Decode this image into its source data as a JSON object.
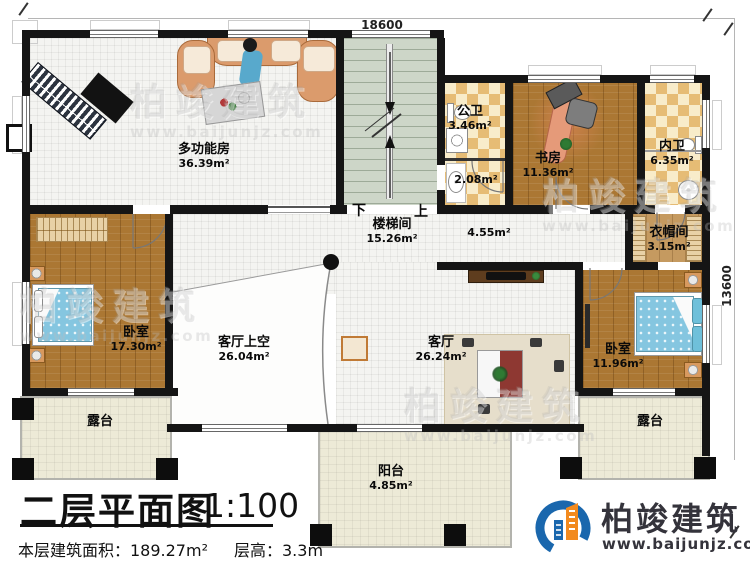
{
  "titleblock": {
    "title": "二层平面图",
    "scale": "1:100",
    "area_text": "本层建筑面积：189.27m²",
    "height_text": "层高：3.3m"
  },
  "dimensions": {
    "top": "18600",
    "right": "13600"
  },
  "stairs": {
    "down_label": "下",
    "up_label": "上"
  },
  "rooms": {
    "multi": {
      "name": "多功能房",
      "area": "36.39m²"
    },
    "public_bath": {
      "name": "公卫",
      "area": "3.46m²"
    },
    "bath_lobby": {
      "area": "2.08m²"
    },
    "study": {
      "name": "书房",
      "area": "11.36m²"
    },
    "inner_bath": {
      "name": "内卫",
      "area": "6.35m²"
    },
    "stairwell": {
      "name": "楼梯间",
      "area": "15.26m²"
    },
    "corridor": {
      "area": "4.55m²"
    },
    "cloakroom": {
      "name": "衣帽间",
      "area": "3.15m²"
    },
    "bedroom_left": {
      "name": "卧室",
      "area": "17.30m²"
    },
    "living_void": {
      "name": "客厅上空",
      "area": "26.04m²"
    },
    "living": {
      "name": "客厅",
      "area": "26.24m²"
    },
    "bedroom_right": {
      "name": "卧室",
      "area": "11.96m²"
    },
    "terrace_left": {
      "name": "露台"
    },
    "terrace_right": {
      "name": "露台"
    },
    "balcony": {
      "name": "阳台",
      "area": "4.85m²"
    }
  },
  "logo": {
    "name": "柏竣建筑",
    "website": "www.baijunjz.com"
  },
  "watermark": {
    "text": "柏竣建筑",
    "sub": "www.baijunjz.com"
  },
  "colors": {
    "wall": "#151515",
    "wood_floor": "#ab7733",
    "tile_checker": "#e6bc75",
    "stair_floor": "#cdd6c8",
    "terrace_floor": "#edead7",
    "bed": "#85c6e0",
    "logo_blue": "#1a67ad",
    "logo_orange": "#f28a1e"
  }
}
